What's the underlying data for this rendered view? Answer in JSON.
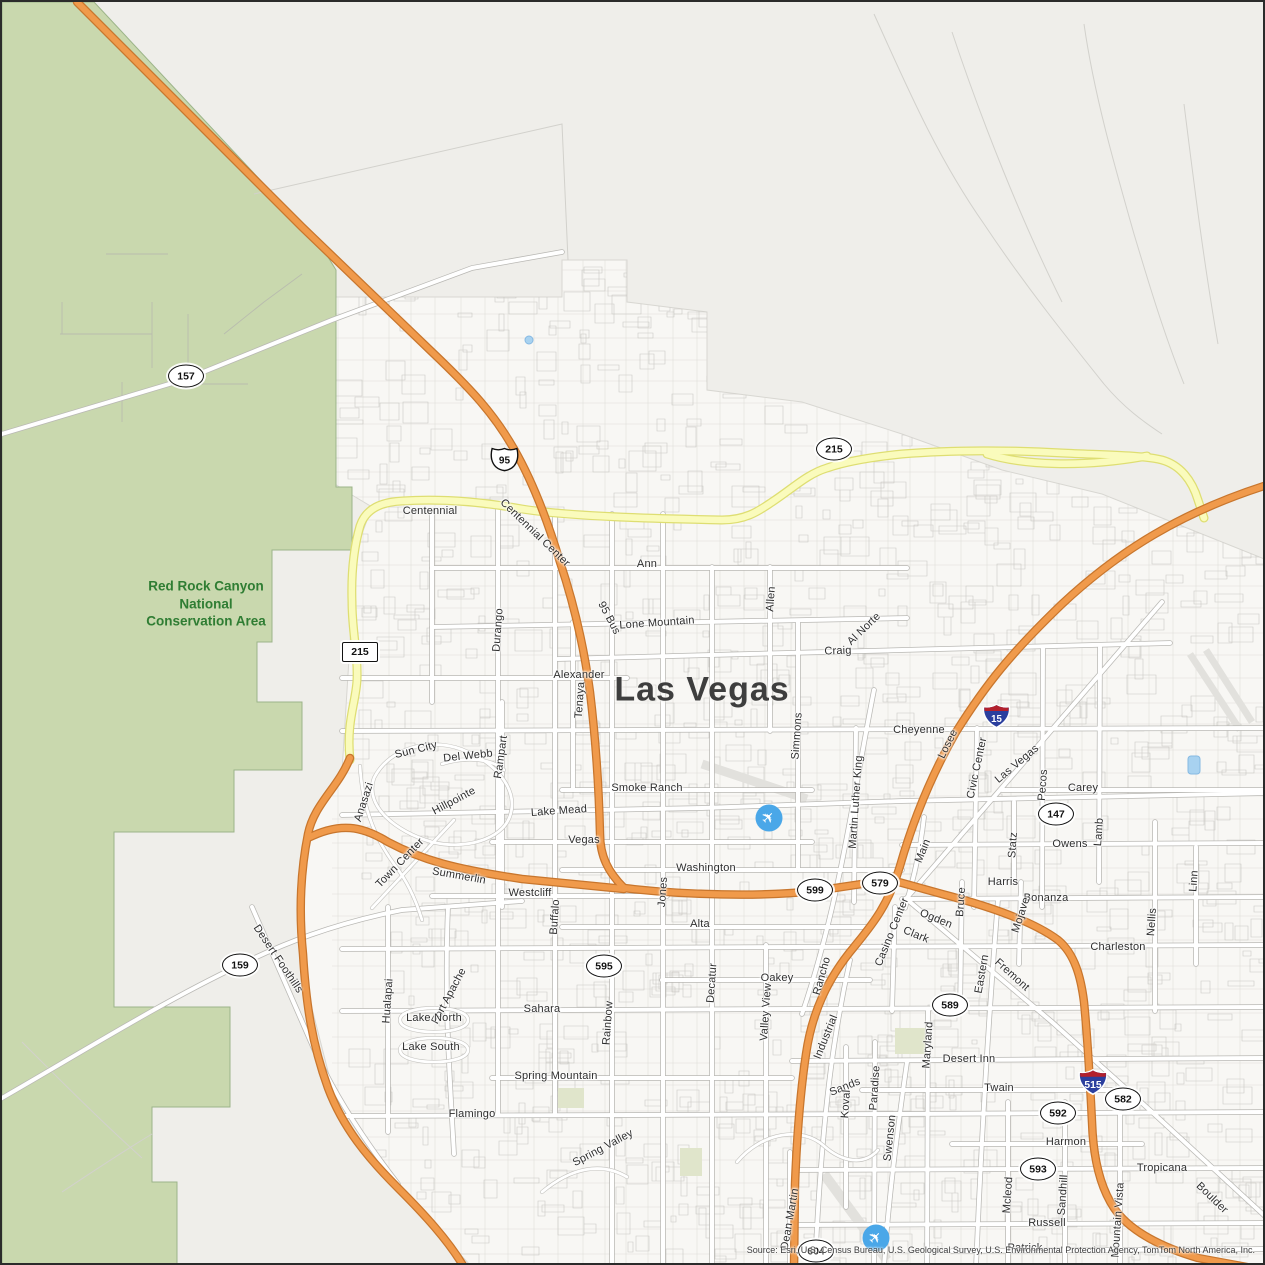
{
  "map": {
    "city_label": "Las Vegas",
    "area_label_lines": [
      "Red Rock Canyon",
      "National",
      "Conservation Area"
    ],
    "source_text": "Source: Esri, U.S. Census Bureau, U.S. Geological Survey, U.S. Environmental Protection Agency, TomTom North America, Inc.",
    "colors": {
      "green_area": "#c9d8ae",
      "freeway_orange": "#f09a4b",
      "freeway_orange_casing": "#c8762d",
      "beltway_yellow": "#fafbbc",
      "beltway_yellow_casing": "#dede72",
      "water_blue": "#a8d2f0",
      "conservation_label_green": "#2f7d33",
      "airport_blue": "#4aa7e8",
      "city_label_gray": "#3e3e3e"
    },
    "airports": [
      {
        "name": "airport-icon",
        "x": 767,
        "y": 816
      },
      {
        "name": "airport-icon",
        "x": 874,
        "y": 1236
      }
    ],
    "shields": [
      {
        "type": "oval",
        "label": "157",
        "x": 184,
        "y": 374
      },
      {
        "type": "us",
        "label": "95",
        "x": 487,
        "y": 443
      },
      {
        "type": "oval",
        "label": "215",
        "x": 832,
        "y": 447
      },
      {
        "type": "rect",
        "label": "215",
        "x": 358,
        "y": 650
      },
      {
        "type": "interstate",
        "label": "15",
        "x": 979,
        "y": 700
      },
      {
        "type": "oval",
        "label": "147",
        "x": 1054,
        "y": 812
      },
      {
        "type": "oval",
        "label": "159",
        "x": 238,
        "y": 963
      },
      {
        "type": "oval",
        "label": "599",
        "x": 813,
        "y": 888
      },
      {
        "type": "oval",
        "label": "579",
        "x": 878,
        "y": 881
      },
      {
        "type": "oval",
        "label": "595",
        "x": 602,
        "y": 964
      },
      {
        "type": "oval",
        "label": "589",
        "x": 948,
        "y": 1003
      },
      {
        "type": "interstate",
        "label": "515",
        "x": 1073,
        "y": 1066
      },
      {
        "type": "oval",
        "label": "582",
        "x": 1121,
        "y": 1097
      },
      {
        "type": "oval",
        "label": "592",
        "x": 1056,
        "y": 1111
      },
      {
        "type": "oval",
        "label": "593",
        "x": 1036,
        "y": 1167
      },
      {
        "type": "oval",
        "label": "604",
        "x": 814,
        "y": 1249
      }
    ],
    "street_labels": [
      {
        "text": "Centennial",
        "x": 428,
        "y": 509,
        "r": 0
      },
      {
        "text": "Centennial Center",
        "x": 533,
        "y": 531,
        "r": 44
      },
      {
        "text": "Ann",
        "x": 645,
        "y": 562,
        "r": 0
      },
      {
        "text": "95 Bus",
        "x": 607,
        "y": 616,
        "r": 62
      },
      {
        "text": "Lone Mountain",
        "x": 655,
        "y": 621,
        "r": -4
      },
      {
        "text": "Alexander",
        "x": 577,
        "y": 673,
        "r": 0
      },
      {
        "text": "Tenaya",
        "x": 578,
        "y": 698,
        "r": -86
      },
      {
        "text": "Durango",
        "x": 496,
        "y": 628,
        "r": -86
      },
      {
        "text": "Craig",
        "x": 836,
        "y": 649,
        "r": -2
      },
      {
        "text": "Allen",
        "x": 769,
        "y": 597,
        "r": -86
      },
      {
        "text": "Al Norte",
        "x": 862,
        "y": 627,
        "r": -44
      },
      {
        "text": "Cheyenne",
        "x": 917,
        "y": 728,
        "r": 0
      },
      {
        "text": "Losee",
        "x": 946,
        "y": 742,
        "r": -64
      },
      {
        "text": "Civic Center",
        "x": 975,
        "y": 766,
        "r": -78
      },
      {
        "text": "Las Vegas",
        "x": 1015,
        "y": 762,
        "r": -40
      },
      {
        "text": "Pecos",
        "x": 1041,
        "y": 783,
        "r": -86
      },
      {
        "text": "Carey",
        "x": 1081,
        "y": 786,
        "r": 0
      },
      {
        "text": "Smoke Ranch",
        "x": 645,
        "y": 786,
        "r": 0
      },
      {
        "text": "Lake Mead",
        "x": 557,
        "y": 809,
        "r": -4
      },
      {
        "text": "Owens",
        "x": 1068,
        "y": 842,
        "r": 0
      },
      {
        "text": "Statz",
        "x": 1011,
        "y": 843,
        "r": -86
      },
      {
        "text": "Lamb",
        "x": 1097,
        "y": 830,
        "r": -86
      },
      {
        "text": "Sun City",
        "x": 414,
        "y": 748,
        "r": -14
      },
      {
        "text": "Del Webb",
        "x": 466,
        "y": 754,
        "r": -6
      },
      {
        "text": "Rampart",
        "x": 499,
        "y": 755,
        "r": -82
      },
      {
        "text": "Hillpointe",
        "x": 452,
        "y": 799,
        "r": -28
      },
      {
        "text": "Vegas",
        "x": 582,
        "y": 838,
        "r": 0
      },
      {
        "text": "Anasazi",
        "x": 362,
        "y": 800,
        "r": -72
      },
      {
        "text": "Town Center",
        "x": 398,
        "y": 861,
        "r": -46
      },
      {
        "text": "Summerlin",
        "x": 457,
        "y": 874,
        "r": 10
      },
      {
        "text": "Washington",
        "x": 704,
        "y": 866,
        "r": 0
      },
      {
        "text": "Martin Luther King",
        "x": 854,
        "y": 800,
        "r": -86
      },
      {
        "text": "Main",
        "x": 921,
        "y": 849,
        "r": -68
      },
      {
        "text": "Harris",
        "x": 1001,
        "y": 880,
        "r": 0
      },
      {
        "text": "Bonanza",
        "x": 1044,
        "y": 896,
        "r": 0
      },
      {
        "text": "Westcliff",
        "x": 528,
        "y": 891,
        "r": 0
      },
      {
        "text": "Jones",
        "x": 661,
        "y": 890,
        "r": -86
      },
      {
        "text": "Buffalo",
        "x": 553,
        "y": 915,
        "r": -86
      },
      {
        "text": "Alta",
        "x": 698,
        "y": 922,
        "r": 0
      },
      {
        "text": "Ogden",
        "x": 934,
        "y": 917,
        "r": 22
      },
      {
        "text": "Casino Center",
        "x": 890,
        "y": 930,
        "r": -68
      },
      {
        "text": "Clark",
        "x": 914,
        "y": 933,
        "r": 22
      },
      {
        "text": "Bruce",
        "x": 959,
        "y": 900,
        "r": -86
      },
      {
        "text": "Mojave",
        "x": 1019,
        "y": 913,
        "r": -72
      },
      {
        "text": "Charleston",
        "x": 1116,
        "y": 945,
        "r": 0
      },
      {
        "text": "Nellis",
        "x": 1150,
        "y": 920,
        "r": -86
      },
      {
        "text": "Linn",
        "x": 1192,
        "y": 879,
        "r": -86
      },
      {
        "text": "Desert Foothills",
        "x": 276,
        "y": 957,
        "r": 56
      },
      {
        "text": "Oakey",
        "x": 775,
        "y": 976,
        "r": 0
      },
      {
        "text": "Rancho",
        "x": 820,
        "y": 974,
        "r": -74
      },
      {
        "text": "Decatur",
        "x": 710,
        "y": 981,
        "r": -86
      },
      {
        "text": "Valley View",
        "x": 764,
        "y": 1010,
        "r": -86
      },
      {
        "text": "Eastern",
        "x": 980,
        "y": 972,
        "r": -80
      },
      {
        "text": "Fremont",
        "x": 1010,
        "y": 973,
        "r": 42
      },
      {
        "text": "Hualapai",
        "x": 386,
        "y": 999,
        "r": -86
      },
      {
        "text": "Fort Apache",
        "x": 447,
        "y": 994,
        "r": -62
      },
      {
        "text": "Lake North",
        "x": 432,
        "y": 1016,
        "r": 0
      },
      {
        "text": "Lake South",
        "x": 429,
        "y": 1045,
        "r": 0
      },
      {
        "text": "Sahara",
        "x": 540,
        "y": 1007,
        "r": 0
      },
      {
        "text": "Rainbow",
        "x": 606,
        "y": 1021,
        "r": -86
      },
      {
        "text": "Spring Mountain",
        "x": 554,
        "y": 1074,
        "r": 0
      },
      {
        "text": "Desert Inn",
        "x": 967,
        "y": 1057,
        "r": 0
      },
      {
        "text": "Maryland",
        "x": 926,
        "y": 1043,
        "r": -86
      },
      {
        "text": "Twain",
        "x": 997,
        "y": 1086,
        "r": 0
      },
      {
        "text": "Sands",
        "x": 843,
        "y": 1085,
        "r": -22
      },
      {
        "text": "Koval",
        "x": 844,
        "y": 1102,
        "r": -86
      },
      {
        "text": "Paradise",
        "x": 873,
        "y": 1086,
        "r": -86
      },
      {
        "text": "Industrial",
        "x": 824,
        "y": 1035,
        "r": -68
      },
      {
        "text": "Flamingo",
        "x": 470,
        "y": 1112,
        "r": 0
      },
      {
        "text": "Spring Valley",
        "x": 601,
        "y": 1146,
        "r": -28
      },
      {
        "text": "Swenson",
        "x": 888,
        "y": 1136,
        "r": -84
      },
      {
        "text": "Harmon",
        "x": 1064,
        "y": 1140,
        "r": 0
      },
      {
        "text": "Tropicana",
        "x": 1160,
        "y": 1166,
        "r": 0
      },
      {
        "text": "Boulder",
        "x": 1210,
        "y": 1196,
        "r": 44
      },
      {
        "text": "Mcleod",
        "x": 1006,
        "y": 1193,
        "r": -86
      },
      {
        "text": "Sandhill",
        "x": 1061,
        "y": 1193,
        "r": -86
      },
      {
        "text": "Mountain Vista",
        "x": 1116,
        "y": 1218,
        "r": -86
      },
      {
        "text": "Russell",
        "x": 1045,
        "y": 1221,
        "r": 0
      },
      {
        "text": "Dean Martin",
        "x": 788,
        "y": 1217,
        "r": -80
      },
      {
        "text": "Patrick",
        "x": 1023,
        "y": 1246,
        "r": 0
      },
      {
        "text": "Simmons",
        "x": 795,
        "y": 734,
        "r": -86
      }
    ]
  }
}
